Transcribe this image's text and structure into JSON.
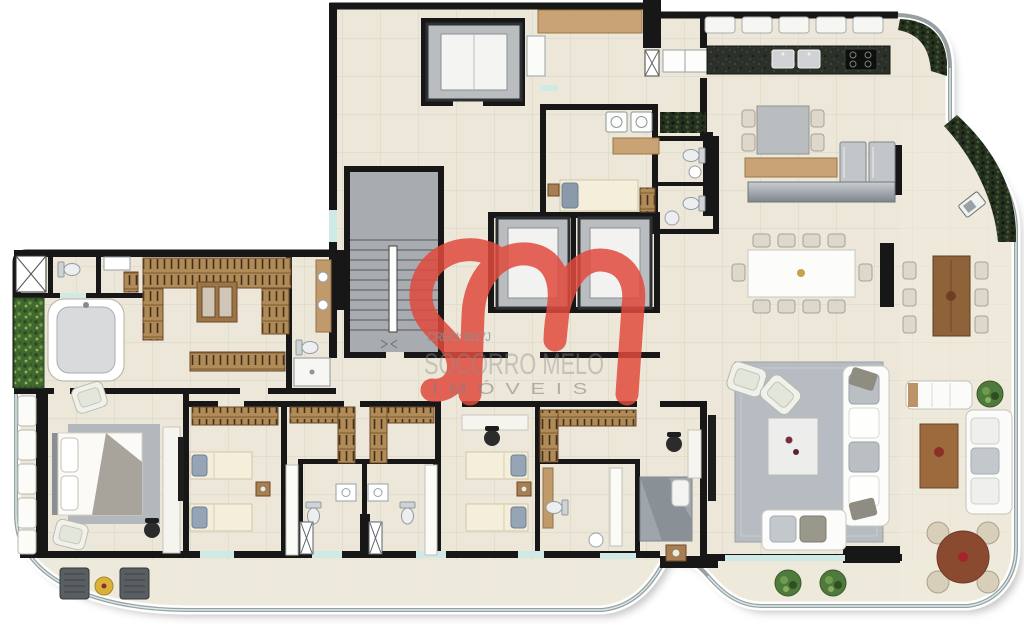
{
  "brand": {
    "monogram_letters": "sm",
    "name": "SOCORRO MELO",
    "subtitle_spaced": "IMÓVEIS",
    "creci": "CRECI: 9317J",
    "logo_color": "#e04a3d",
    "watermark_text_color": "#8f8f8f"
  },
  "palette": {
    "background": "#ffffff",
    "floor": "#ece7d8",
    "wall": "#171717",
    "wood": "#b68b5a",
    "granite": "#2b3028",
    "glass_window": "#cfe9e6",
    "rug": "#b6bcc1",
    "plant": "#4f7a3c",
    "hedge": "#25311e",
    "shadow": "rgba(0,0,0,0.22)"
  }
}
